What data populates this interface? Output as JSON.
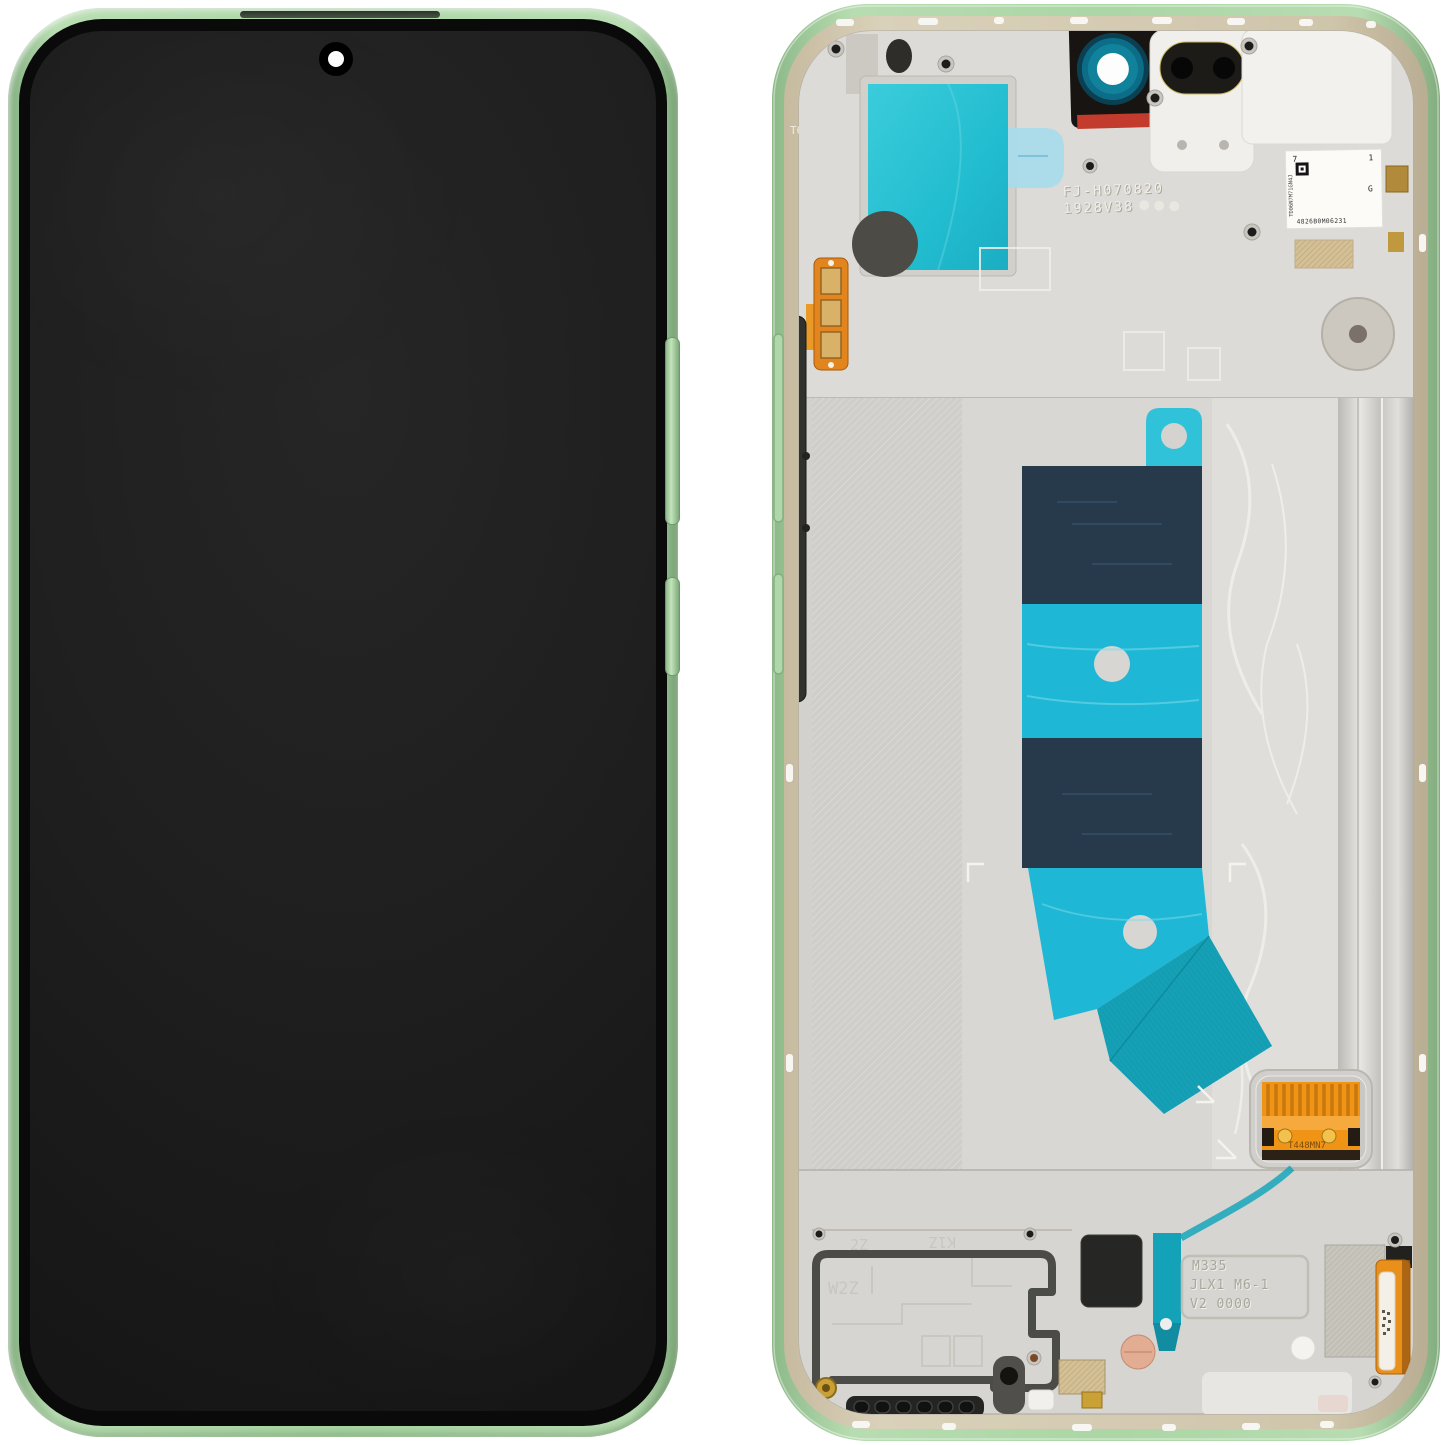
{
  "scene": {
    "background_color": "#ffffff",
    "subject": "Smartphone display assembly spare part, front view and back (inner) view, green frame"
  },
  "front_view": {
    "screen_state": "off"
  },
  "back_view": {
    "rim_mark": "T6",
    "stamp": {
      "line1": "FJ-H070820",
      "line2": "1928V38"
    },
    "qr_label": {
      "corner_left": "7",
      "corner_right": "1",
      "side_right": "G",
      "code": "4826B0M06231",
      "side_code": "TD06N7M71GN4J"
    },
    "connector_label": "T448MN7",
    "speaker_plate": {
      "mark_a": "2Z",
      "mark_b": "K1Z",
      "mark_c": "W2Z"
    },
    "embossed_panel": {
      "line1": "M335",
      "line2": "JLX1 M6-1",
      "line3": "V2 0000"
    },
    "colors": {
      "frame_green": "#abd6a5",
      "rim_beige": "#cfc5ab",
      "chassis_silver": "#d7d6d2",
      "adhesive_cyan_bright": "#2cc6d8",
      "adhesive_cyan": "#1eb7d5",
      "adhesive_navy": "#273a4b",
      "adhesive_teal": "#15a0b6",
      "flex_orange": "#f09416",
      "gold": "#c9a035",
      "sticker_red": "#dc3227",
      "screen_black": "#1c1c1c"
    }
  }
}
